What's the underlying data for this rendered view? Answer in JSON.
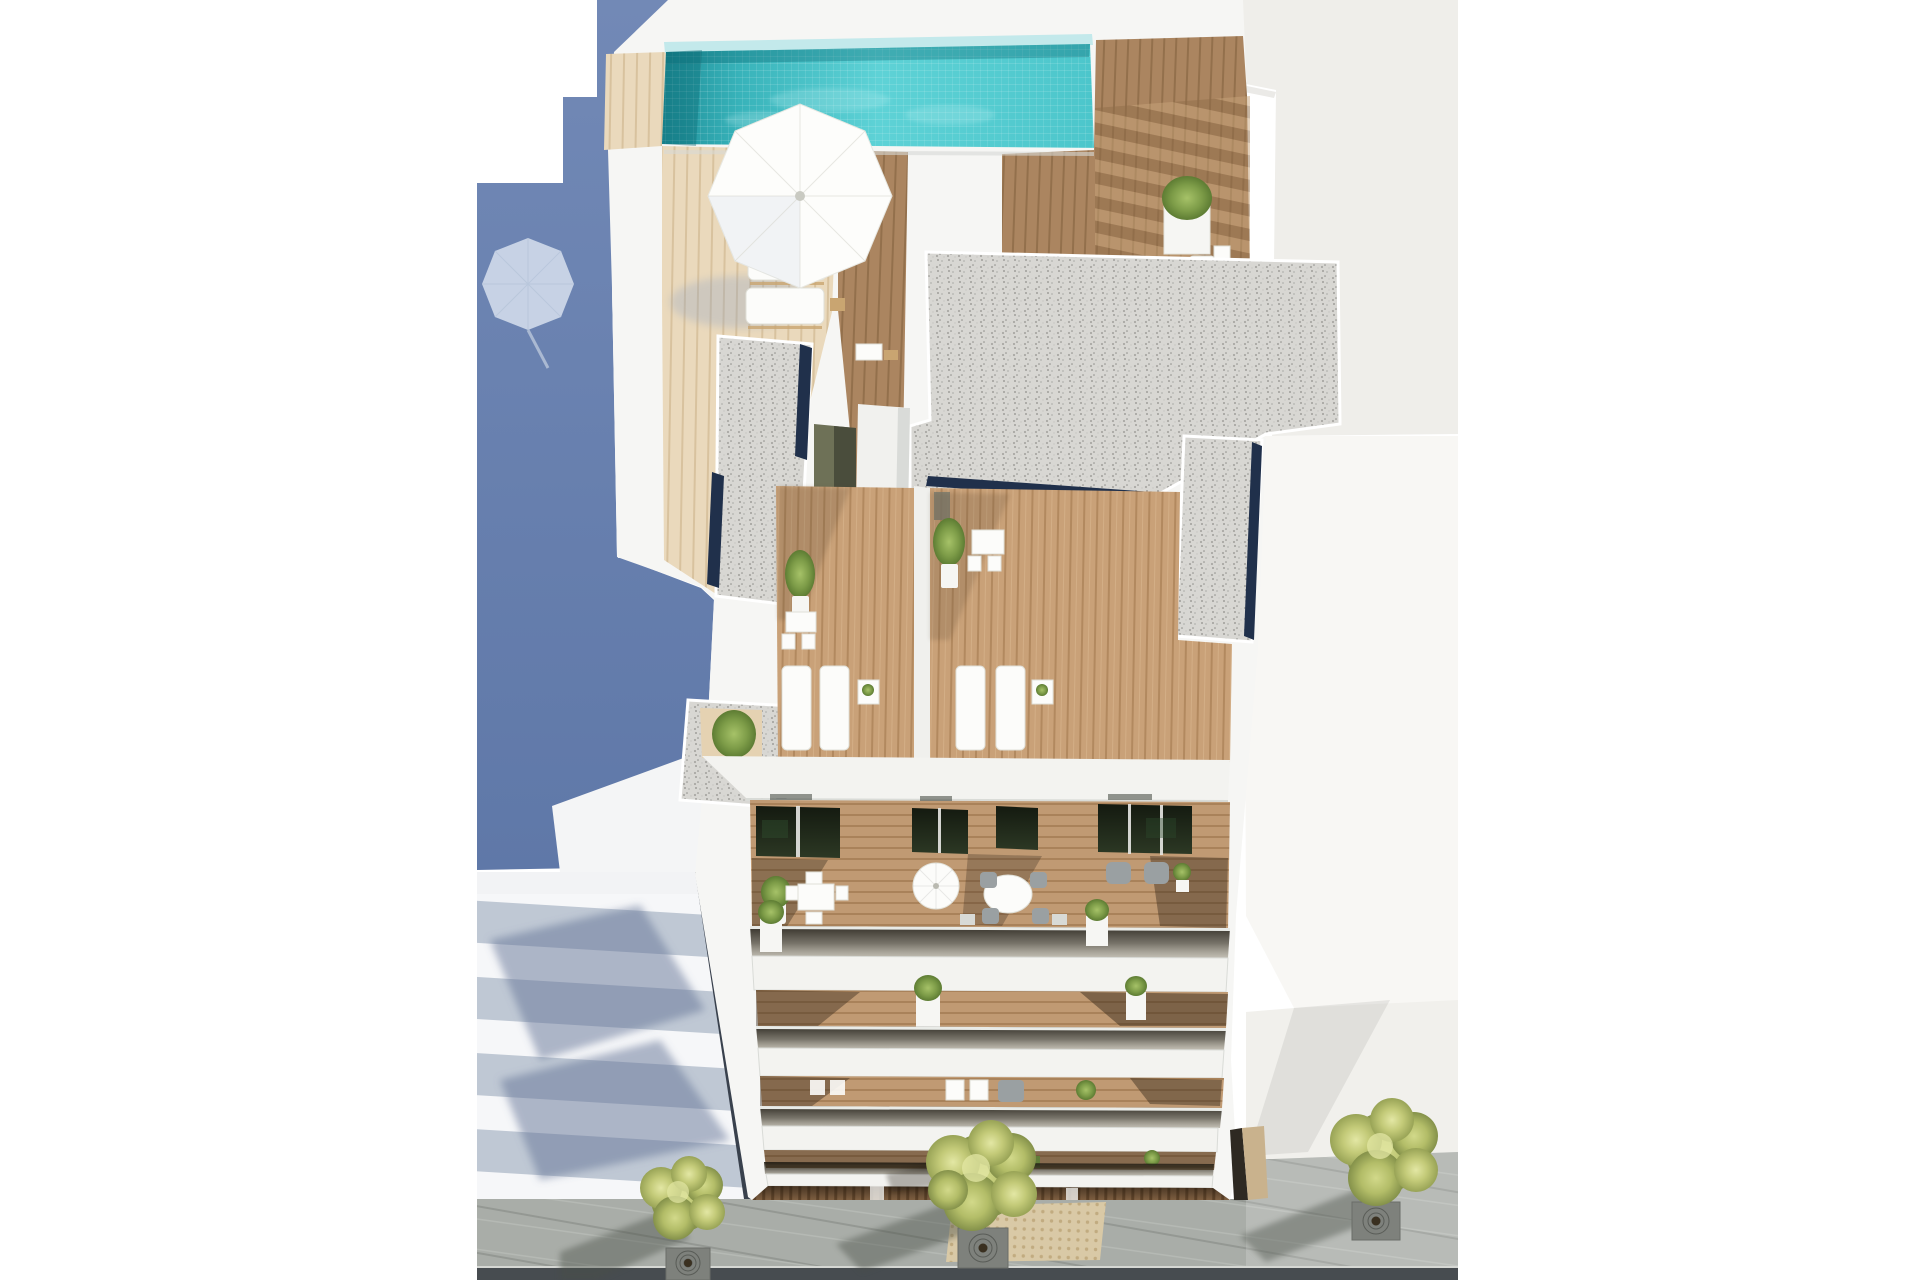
{
  "scene": {
    "kind": "aerial-3d-architectural-render",
    "subject": "modern-white-apartment-building",
    "view": "top-down-oblique",
    "visible_objects": {
      "rooftop_pool": 1,
      "rooftop_parasol": 1,
      "rooftop_sun_loungers": 3,
      "gravel_roof_patches": 4,
      "roof_terraces": 2,
      "terrace_loungers_per_terrace": 2,
      "balcony_floors": 4,
      "street_trees": 3,
      "tree_grates": 3,
      "tactile_paving_patches": 1,
      "neighbor_buildings": 2
    }
  },
  "palette": {
    "canvas": "#ffffff",
    "blueTop": "#7289b6",
    "blueBot": "#5f78a8",
    "blueUmbrella": "#ccd7e8",
    "blueUmbrellaSeam": "#b9c6dc",
    "bandLight": "#f6f7f9",
    "bandDark": "#bfc8d4",
    "bandShadow": "#63749680",
    "alley": "#39414d",
    "buildingWhite": "#f6f6f4",
    "slab": "#f3f3f0",
    "slabLine": "#d9dbd7",
    "poolDeep": "#1f8e98",
    "poolMid": "#38b3ba",
    "poolLight": "#5ed2d6",
    "poolEnd": "#4cc6cb",
    "poolLip": "#c3e9eb",
    "poolDark": "#0a6872",
    "deckLight": "#ead9bc",
    "deckLightLine": "#d8c29e",
    "deckWood": "#ab8560",
    "deckWoodLine": "#93704c",
    "terrWood": "#c9a178",
    "terrWoodLine": "#b2895f",
    "balcWood": "#c09a73",
    "balcWoodLine": "#a9825a",
    "slatWood": "#7d5e40",
    "slatWoodLine": "#5e4329",
    "gravel": "#d8d7d3",
    "gravelDotA": "#a9a8a4",
    "gravelDotB": "#8f8e8a",
    "navy": "#20304b",
    "doorOlive": "#6e7157",
    "doorOliveDark": "#4a4d3c",
    "glassDoorA": "#141a10",
    "glassDoorB": "#2c3824",
    "furnWhite": "#fcfcfa",
    "furnLine": "#e0e0d8",
    "furnTan": "#c9a571",
    "furnGray": "#9aa0a2",
    "potWhite": "#f6f6f3",
    "hedge": "#5f7e39",
    "treeLightA": "#d2d98a",
    "treeLightB": "#e3e7a4",
    "treeMidA": "#b3bd68",
    "treeMidB": "#c3ca78",
    "treeDarkA": "#84914a",
    "treeDarkB": "#98a356",
    "trunk": "#3a3020",
    "grate": "#7e817c",
    "grateRing": "#595c57",
    "pave": "#a9ada8",
    "paveJoint": "#7f837e",
    "paveLight": "#c2c5c0",
    "tactile": "#d9c9a6",
    "tactileDot": "#c1ab80",
    "road": "#474c50",
    "curb": "#d5d7d3",
    "shadow": "#4a5046",
    "neighborRoof": "#efeeea",
    "neighborWall": "#f8f7f4",
    "plaza": "#f1f0ec",
    "beige": "#c9b28d",
    "recessDark": "#2e2922",
    "bushOuter": "#5d7c33"
  }
}
